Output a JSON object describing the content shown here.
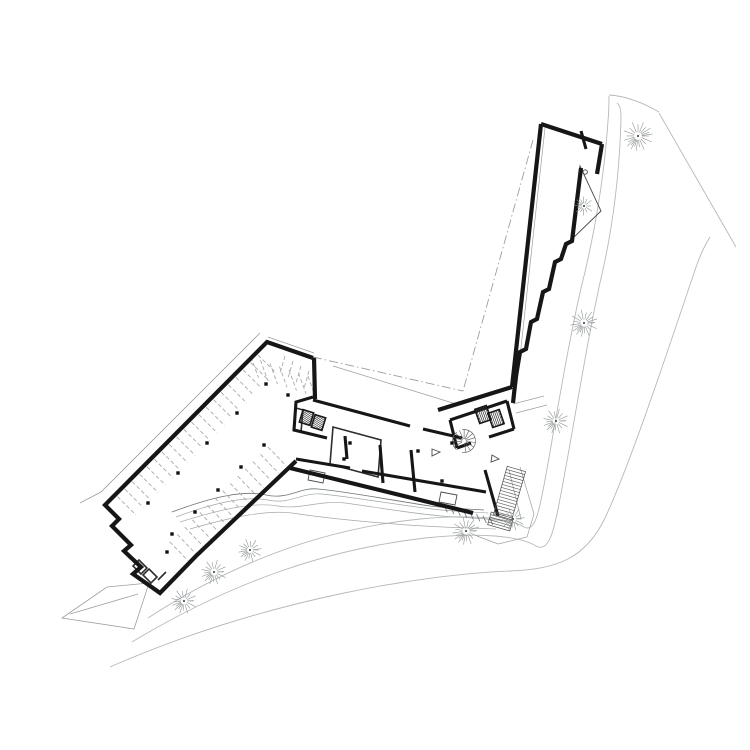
{
  "meta": {
    "document_kind": "architectural-site-floor-plan",
    "visible_text": []
  },
  "canvas": {
    "width": 750,
    "height": 750,
    "bg": "#ffffff"
  },
  "styles": {
    "road": {
      "stroke": "#b5b9bb",
      "width": 0.9
    },
    "roadDark": {
      "stroke": "#a8acae",
      "width": 0.8
    },
    "site": {
      "stroke": "#9ba0a2",
      "width": 0.8
    },
    "contour": {
      "stroke": "#a3a8aa",
      "width": 0.7
    },
    "contourDark": {
      "stroke": "#6e7375",
      "width": 0.8
    },
    "thinLight": {
      "stroke": "#9ba0a2",
      "width": 0.7
    },
    "detail": {
      "stroke": "#4a4a4a",
      "width": 0.9
    },
    "stall": {
      "stroke": "#a7abad",
      "width": 0.9,
      "dash": "4 2.4"
    },
    "dashdot": {
      "stroke": "#9a9ea0",
      "width": 0.9,
      "dash": "9 3 1.5 3"
    },
    "wallHeavy": {
      "stroke": "#161616",
      "width": 4.2
    },
    "wall": {
      "stroke": "#161616",
      "width": 3.1
    },
    "wallMed": {
      "stroke": "#2e2e2e",
      "width": 1.6
    },
    "tread": {
      "stroke": "#4a4a4a",
      "width": 0.6
    }
  },
  "layers": [
    {
      "name": "road-edges",
      "kind": "paths",
      "style": "road",
      "paths": [
        "M 148,618 C 240,558 330,528 420,519 C 470,514 510,518 524,527 C 535,533 539,512 545,480 C 553,437 570,330 585,272 C 597,220 605,166 608,121 C 609,110 609,101 609,96",
        "M 132,642 C 235,580 330,549 425,538 C 480,532 520,536 536,546 C 549,553 554,530 559,504 C 571,443 588,334 602,274 C 613,226 620,170 621,117 C 621,110 620,105 617,103",
        "M 609,95 C 628,96 645,104 659,112",
        "M 110,667 C 270,597 430,574 510,571 C 555,569 585,560 605,518 C 630,465 668,350 695,270 C 700,255 705,245 710,237",
        "M 659,113 L 736,247"
      ]
    },
    {
      "name": "site-lines",
      "kind": "paths",
      "style": "site",
      "paths": [
        "M 260,333 L 101,492 L 80,503",
        "M 268,337 L 314,353",
        "M 62,618 L 107,587 L 149,583 L 134,629 Z",
        "M 70,614 L 138,594"
      ]
    },
    {
      "name": "contours",
      "kind": "paths",
      "style": "contour",
      "paths": [
        "M 180,522 C 225,508 255,502 278,506 C 300,510 320,500 345,503 C 375,507 420,515 455,517 C 475,518 490,519 504,521",
        "M 190,529 C 235,516 268,510 292,513 C 318,517 355,521 395,524 C 430,527 465,528 496,529",
        "M 176,517 C 216,502 248,496 268,500 C 290,505 302,492 322,494 C 352,497 392,504 432,509 C 458,512 472,512 488,513"
      ]
    },
    {
      "name": "contour-accent",
      "kind": "paths",
      "style": "contourDark",
      "paths": [
        "M 172,512 C 215,496 245,490 266,495 C 288,500 300,487 318,489 C 350,492 390,500 430,506 C 455,509 470,509 484,510"
      ]
    },
    {
      "name": "contour-hatch",
      "kind": "ticks",
      "style": "contourDark",
      "ticks": {
        "x": 444,
        "y": 505,
        "sx": 6.5,
        "sy": 1.8,
        "dx": 0.42,
        "dy": 0.91,
        "len": 8,
        "count": 8
      }
    },
    {
      "name": "parking-stalls-nw",
      "kind": "ticks",
      "style": "stall",
      "ticks": {
        "x": 258,
        "y": 355,
        "sx": -7.4,
        "sy": 7.45,
        "dx": 0.709,
        "dy": 0.705,
        "len": 26,
        "count": 20
      }
    },
    {
      "name": "parking-stalls-se",
      "kind": "ticks",
      "style": "stall",
      "ticks": {
        "x": 268,
        "y": 447,
        "sx": -7.56,
        "sy": 7.29,
        "dx": 0.694,
        "dy": 0.72,
        "len": 26,
        "count": 14
      }
    },
    {
      "name": "parking-stalls-end-a",
      "kind": "ticks",
      "style": "stall",
      "ticks": {
        "x": 251,
        "y": 357,
        "sx": 9.5,
        "sy": 3.2,
        "dx": 0.34,
        "dy": 0.94,
        "len": 22,
        "count": 7
      }
    },
    {
      "name": "parking-stalls-end-b",
      "kind": "ticks",
      "style": "stall",
      "ticks": {
        "x": 285,
        "y": 356,
        "sx": 8,
        "sy": 5,
        "dx": -0.28,
        "dy": 0.96,
        "len": 18,
        "count": 4
      }
    },
    {
      "name": "plaza-lines",
      "kind": "paths",
      "style": "thinLight",
      "paths": [
        "M 333,366 L 456,404",
        "M 545,128 L 517,384"
      ]
    },
    {
      "name": "terrace-details",
      "kind": "paths",
      "style": "thinLight",
      "paths": [
        "M 520,467 L 534,514 L 527,537 L 498,544 L 477,536",
        "M 513,404 L 544,396",
        "M 516,413 L 547,405",
        "M 509,470 L 521,519"
      ]
    },
    {
      "name": "atrium-triangle",
      "kind": "paths",
      "style": "detail",
      "paths": [
        "M 580,166 L 601,211 L 571,240 Z",
        "M 583,172 A 2.2,2.2 0 1 0 587.4,172 A 2.2,2.2 0 1 0 583,172",
        "M 310,470 L 325,473 L 323,483 L 308,480 Z",
        "M 441,492 L 457,495 L 455,505 L 439,502 Z",
        "M 432,449 L 440,452 L 432,456 Z",
        "M 492,455 L 499,459 L 491,462 Z"
      ]
    },
    {
      "name": "interior-medium-walls",
      "kind": "paths",
      "style": "wallMed",
      "paths": [
        "M 333,427 L 381,440 L 378,477 L 330,464 Z",
        "M 139,560 L 147,568 L 141,574 L 133,566 Z",
        "M 149,569 L 157,577 L 151,583 L 143,575 Z",
        "M 158,580 L 166,572",
        "M 296,408 L 303,410 L 301,432 L 294,430 Z"
      ]
    },
    {
      "name": "walls-heavy",
      "kind": "paths",
      "style": "wallHeavy",
      "paths": [
        "M 541,124 L 512,387",
        "M 541,124 L 602,144",
        "M 602,144 L 597,174",
        "M 581,168 L 572,241 L 566,244 L 561,259 L 555,262 L 549,289 L 543,292 L 537,319 L 531,322 L 526,349 L 520,352 L 516,376 L 513,403",
        "M 313,358 L 267,342 L 105,505 L 119,519 L 112,526 L 131,545 L 124,551 L 141,567 L 133,574 L 160,593 L 196,556 L 296,461",
        "M 314,357 L 315,399",
        "M 290,468 L 473,513",
        "M 438,410 L 512,387"
      ]
    },
    {
      "name": "walls-thick",
      "kind": "paths",
      "style": "wall",
      "paths": [
        "M 313,400 L 410,426",
        "M 423,429 L 462,438",
        "M 296,459 L 350,468",
        "M 362,471 L 486,492",
        "M 313,397 L 296,402 L 294,430 L 327,438",
        "M 450,420 L 507,401",
        "M 507,401 L 514,429",
        "M 514,429 L 489,437",
        "M 471,443 L 457,448",
        "M 457,448 L 450,420",
        "M 380,445 L 383,483",
        "M 411,450 L 415,492",
        "M 485,470 L 498,516",
        "M 581,131 L 586,149",
        "M 345,436 L 347,459"
      ]
    },
    {
      "name": "setback-dashdot",
      "kind": "paths",
      "style": "dashdot",
      "paths": [
        "M 533,140 L 463,391",
        "M 313,357 L 463,391"
      ]
    },
    {
      "name": "exterior-stairs",
      "kind": "stairs",
      "items": [
        {
          "x": 500,
          "y": 468,
          "w": 19,
          "h": 50,
          "rot": 16,
          "n": 15
        },
        {
          "x": 489,
          "y": 515,
          "w": 23,
          "h": 13,
          "rot": 16,
          "n": 4
        }
      ]
    },
    {
      "name": "elevator-shafts",
      "kind": "hatchrect",
      "items": [
        {
          "x": 301,
          "y": 411,
          "w": 11,
          "h": 13,
          "rot": 17,
          "n": 4
        },
        {
          "x": 313,
          "y": 416,
          "w": 11,
          "h": 13,
          "rot": 17,
          "n": 4
        },
        {
          "x": 477,
          "y": 407,
          "w": 12,
          "h": 15,
          "rot": -19,
          "n": 4
        },
        {
          "x": 490,
          "y": 411,
          "w": 12,
          "h": 15,
          "rot": -19,
          "n": 4
        }
      ]
    },
    {
      "name": "spiral-stair",
      "kind": "spiral",
      "item": {
        "cx": 464,
        "cy": 441,
        "r": 11.5,
        "n": 12,
        "a0": -210,
        "a1": 80
      }
    },
    {
      "name": "structural-columns",
      "kind": "squares",
      "size": 3.4,
      "items": [
        [
          266,
          384
        ],
        [
          237,
          413
        ],
        [
          207,
          443
        ],
        [
          178,
          473
        ],
        [
          148,
          503
        ],
        [
          264,
          445
        ],
        [
          241,
          467
        ],
        [
          218,
          490
        ],
        [
          195,
          512
        ],
        [
          172,
          534
        ],
        [
          350,
          443
        ],
        [
          344,
          459
        ],
        [
          418,
          451
        ],
        [
          452,
          443
        ],
        [
          442,
          481
        ],
        [
          288,
          395
        ],
        [
          167,
          552
        ]
      ]
    },
    {
      "name": "trees",
      "kind": "trees",
      "items": [
        [
          638,
          136,
          14
        ],
        [
          584,
          206,
          9
        ],
        [
          584,
          323,
          13
        ],
        [
          556,
          421,
          12
        ],
        [
          513,
          519,
          11
        ],
        [
          466,
          531,
          13
        ],
        [
          250,
          550,
          11
        ],
        [
          214,
          572,
          12
        ],
        [
          184,
          601,
          12
        ]
      ]
    }
  ]
}
